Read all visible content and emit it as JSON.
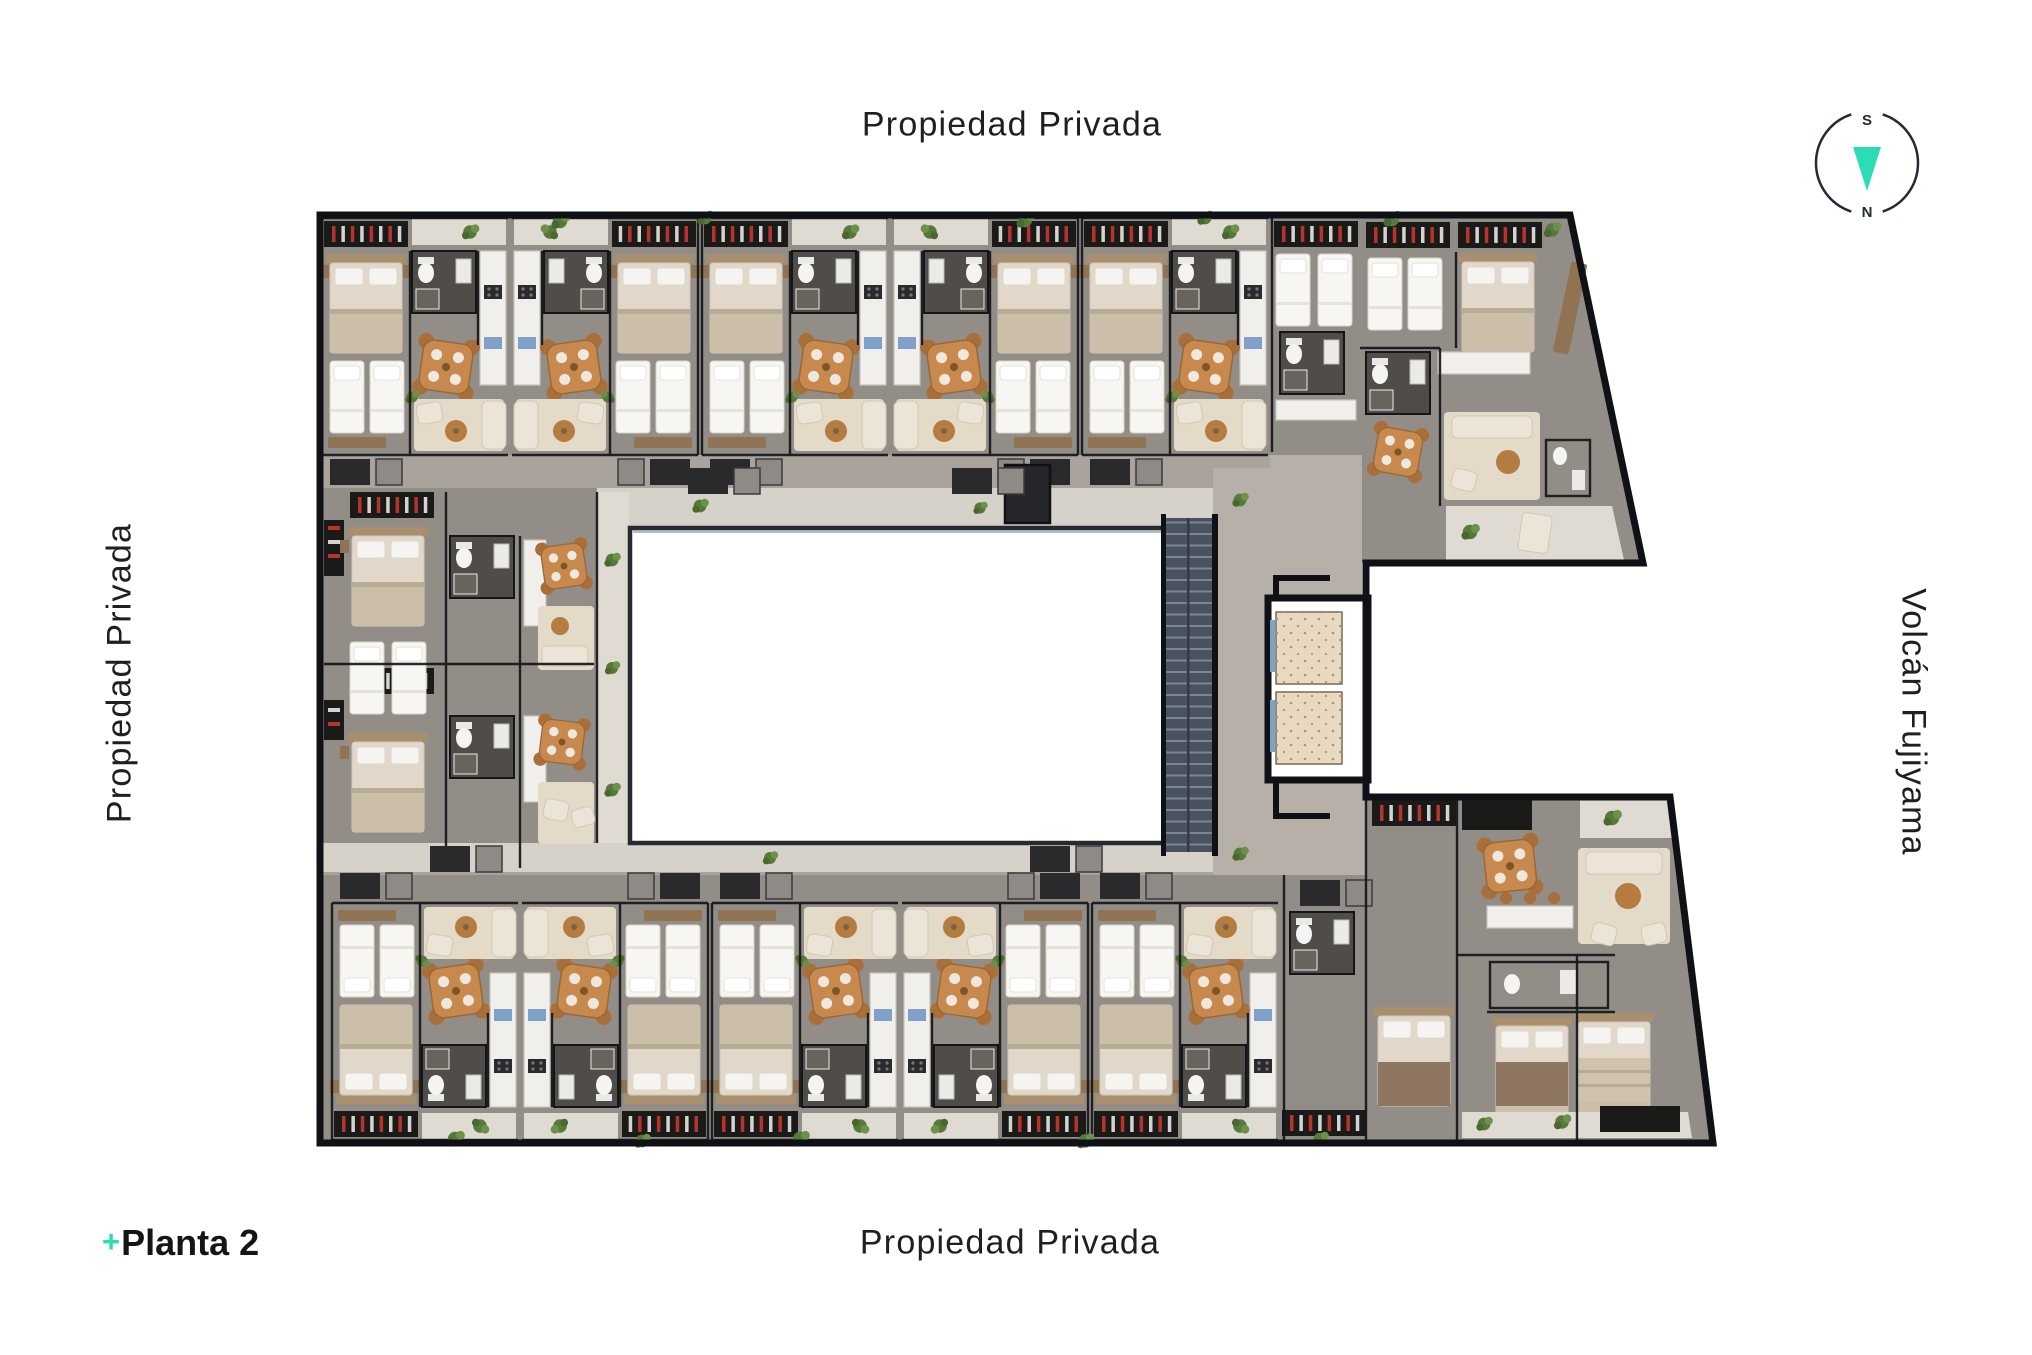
{
  "canvas": {
    "width": 2032,
    "height": 1355,
    "background": "#FFFFFF"
  },
  "labels": {
    "top": "Propiedad Privada",
    "left": "Propiedad Privada",
    "bottom": "Propiedad Privada",
    "right": "Volcán Fujiyama"
  },
  "legend": {
    "plus": "+",
    "title": "Planta 2"
  },
  "compass": {
    "south": "S",
    "north": "N"
  },
  "plan": {
    "type": "residential-floor-plan",
    "floor": "Planta 2",
    "features": [
      "central-courtyard",
      "staircase",
      "two-elevators",
      "apartment-units",
      "balconies-with-plants",
      "diagonal-east-facade"
    ]
  },
  "palette": {
    "accent_teal": "#2BDCB5",
    "text_dark": "#1F1F1F",
    "title_dark": "#141419",
    "compass_ring": "#232B38",
    "wall": "#15161A",
    "outline": "#0F1116",
    "unit_floor": "#928D87",
    "corridor": "#B6B0A8",
    "walkway": "#D6D1C9",
    "balcony": "#DFDAD2",
    "planter_zone": "#A9A39B",
    "courtyard": "#FFFFFF",
    "bath": "#504C47",
    "kitchen": "#F1EFEB",
    "kitchen_accent": "#7FA1C9",
    "wood_table": "#C8894F",
    "chair_wood": "#A96F3A",
    "rug": "#E3DAC8",
    "sofa": "#ECE5D7",
    "bed_white": "#F7F6F3",
    "bed_sheet": "#E1D8CA",
    "blanket": "#CBBFA9",
    "headboard": "#A8906F",
    "closet": "#1A1A19",
    "closet_red": "#B7342C",
    "plant": "#57793A",
    "stairs": "#49525E",
    "stair_tread": "#7B8692",
    "elevator_cab": "#EAD9C1",
    "nightstand": "#8F7352"
  }
}
